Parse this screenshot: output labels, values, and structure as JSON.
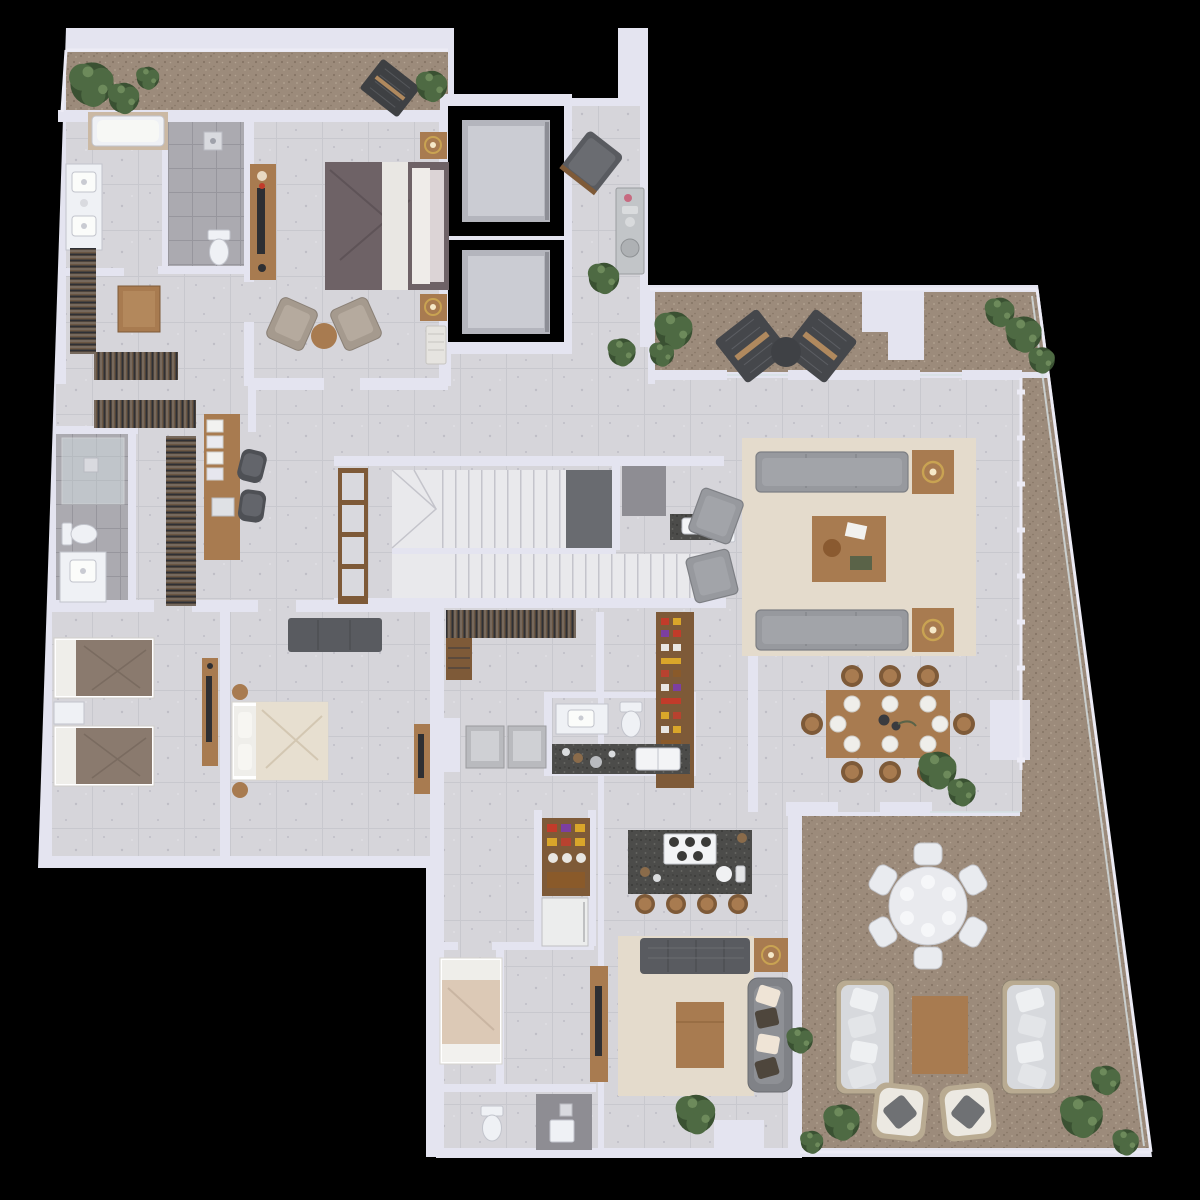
{
  "meta": {
    "title": "penthouse-floor-plan-3d-render",
    "canvas": {
      "width": 1200,
      "height": 1200
    },
    "view": "top-down architectural render on black background",
    "visible_text": "none"
  },
  "palette": {
    "outside": "#000000",
    "wall": "#e4e4f0",
    "wall-dim": "#cdcddd",
    "floor-base": "#d6d5da",
    "floor-line": "#c5c4cb",
    "floor-dot": "#bfbec6",
    "terrace-base": "#9c8b7b",
    "terrace-dot": "#857565",
    "terrace-dot-light": "#b3a392",
    "wet-base": "#abaab0",
    "wet-line": "#97969d",
    "wet-dark": "#8e8d93",
    "granite": "#4c4c4a",
    "granite-dot": "#3a3a38",
    "granite-dot-light": "#6b6b66",
    "wood": "#a87b50",
    "wood-dark": "#7e5a38",
    "wood-light": "#c29a6a",
    "sofa": "#97999e",
    "sofa-line": "#7d7f84",
    "sofa-dark": "#595b60",
    "taupe": "#a59a8e",
    "bed-dark": "#6e6266",
    "duvet-brown": "#8a7a6e",
    "linen": "#efeeea",
    "cream": "#e7dfd0",
    "rug": "#e4dbcc",
    "fixture": "#eff1f5",
    "fixture-line": "#c2c4cc",
    "steel": "#c2c5c8",
    "gold": "#c9a352",
    "car": "#b4b5bd",
    "car-light": "#cbccd3",
    "stair": "#e9e9ec",
    "stair-line": "#c4c4cb",
    "stair-dark": "#696b70",
    "plant": "#4e6a43",
    "plant-dark": "#3a5132",
    "plant-light": "#6d8a5b",
    "rail": "#ecebf5",
    "glass": "#d6e0e4",
    "cushion-white": "#eef0f2",
    "pillow-dark": "#6f7174",
    "accent-red": "#c23b2a"
  },
  "scene": {
    "rooms": [
      {
        "name": "balcony-strip-northwest",
        "floor": "terrace",
        "items": [
          "plants",
          "lounge-mat",
          "potted-plant",
          "railing"
        ]
      },
      {
        "name": "master-bathroom",
        "floor": "stone",
        "items": [
          "bathtub",
          "walk-in-shower",
          "toilet",
          "double-vanity"
        ]
      },
      {
        "name": "master-walk-in-closet",
        "floor": "stone",
        "items": [
          "clothes-racks",
          "closet-island"
        ]
      },
      {
        "name": "master-bedroom",
        "floor": "stone",
        "items": [
          "king-bed",
          "nightstand-with-lamp",
          "nightstand-with-lamp",
          "bench",
          "tv-console",
          "armchair",
          "armchair",
          "round-side-table"
        ]
      },
      {
        "name": "dressing-office",
        "floor": "stone",
        "items": [
          "desk",
          "office-chair",
          "office-chair",
          "laptop",
          "clothes-rack",
          "clothes-rack"
        ]
      },
      {
        "name": "bathroom-two",
        "floor": "wet-tile",
        "items": [
          "glass-shower",
          "toilet",
          "vanity"
        ]
      },
      {
        "name": "twin-bedroom",
        "floor": "stone",
        "items": [
          "twin-bed",
          "twin-bed",
          "nightstand",
          "tv-console"
        ]
      },
      {
        "name": "guest-bedroom",
        "floor": "stone",
        "items": [
          "queen-bed",
          "sofa",
          "round-stool",
          "round-stool",
          "tv-console"
        ]
      },
      {
        "name": "stair-hall",
        "floor": "stone",
        "items": [
          "bookshelf",
          "stair-flight-upper",
          "stair-landing",
          "stair-flight-lower",
          "clothes-rack",
          "shoe-shelf"
        ]
      },
      {
        "name": "stair-bathroom",
        "floor": "stone",
        "items": [
          "shower",
          "stone-vanity",
          "toilet"
        ]
      },
      {
        "name": "elevator-core",
        "floor": "none",
        "items": [
          "elevator-shaft",
          "elevator-cab",
          "elevator-shaft",
          "elevator-cab"
        ]
      },
      {
        "name": "elevator-lobby",
        "floor": "stone",
        "items": [
          "lounge-chair",
          "grill-station",
          "plant",
          "plant"
        ]
      },
      {
        "name": "terrace-north",
        "floor": "terrace",
        "items": [
          "lounge-chair",
          "lounge-chair",
          "round-table",
          "plants",
          "column"
        ]
      },
      {
        "name": "living-room",
        "floor": "stone",
        "items": [
          "rug",
          "sofa",
          "sofa",
          "armchair",
          "armchair",
          "coffee-table",
          "side-table-with-lamp",
          "side-table-with-lamp",
          "plant"
        ]
      },
      {
        "name": "dining-area",
        "floor": "stone",
        "items": [
          "dining-table",
          "dining-chairs-x8",
          "place-settings",
          "centerpiece"
        ]
      },
      {
        "name": "pantry",
        "floor": "stone",
        "items": [
          "pantry-shelving"
        ]
      },
      {
        "name": "powder-room",
        "floor": "stone",
        "items": [
          "vanity",
          "toilet"
        ]
      },
      {
        "name": "kitchen",
        "floor": "stone",
        "items": [
          "granite-counter-with-sink",
          "coffee-station",
          "island-with-cooktop",
          "bar-stool-x4",
          "bar-cabinet",
          "refrigerator"
        ]
      },
      {
        "name": "laundry-nook",
        "floor": "stone",
        "items": [
          "washer",
          "dryer"
        ]
      },
      {
        "name": "family-room",
        "floor": "stone",
        "items": [
          "rug",
          "tufted-sofa",
          "sofa-with-pillows",
          "coffee-table",
          "tv-console",
          "side-table-with-lamp",
          "plant"
        ]
      },
      {
        "name": "service-bedroom",
        "floor": "stone",
        "items": [
          "single-bed"
        ]
      },
      {
        "name": "service-bathroom",
        "floor": "wet-tile",
        "items": [
          "toilet",
          "sink",
          "shower"
        ]
      },
      {
        "name": "terrace-east-south",
        "floor": "terrace",
        "items": [
          "round-dining-table",
          "outdoor-chair-x6",
          "outdoor-sofa",
          "outdoor-sofa",
          "coffee-table",
          "lounge-armchair",
          "lounge-armchair",
          "planter-block",
          "plants",
          "glass-railing"
        ]
      }
    ]
  }
}
